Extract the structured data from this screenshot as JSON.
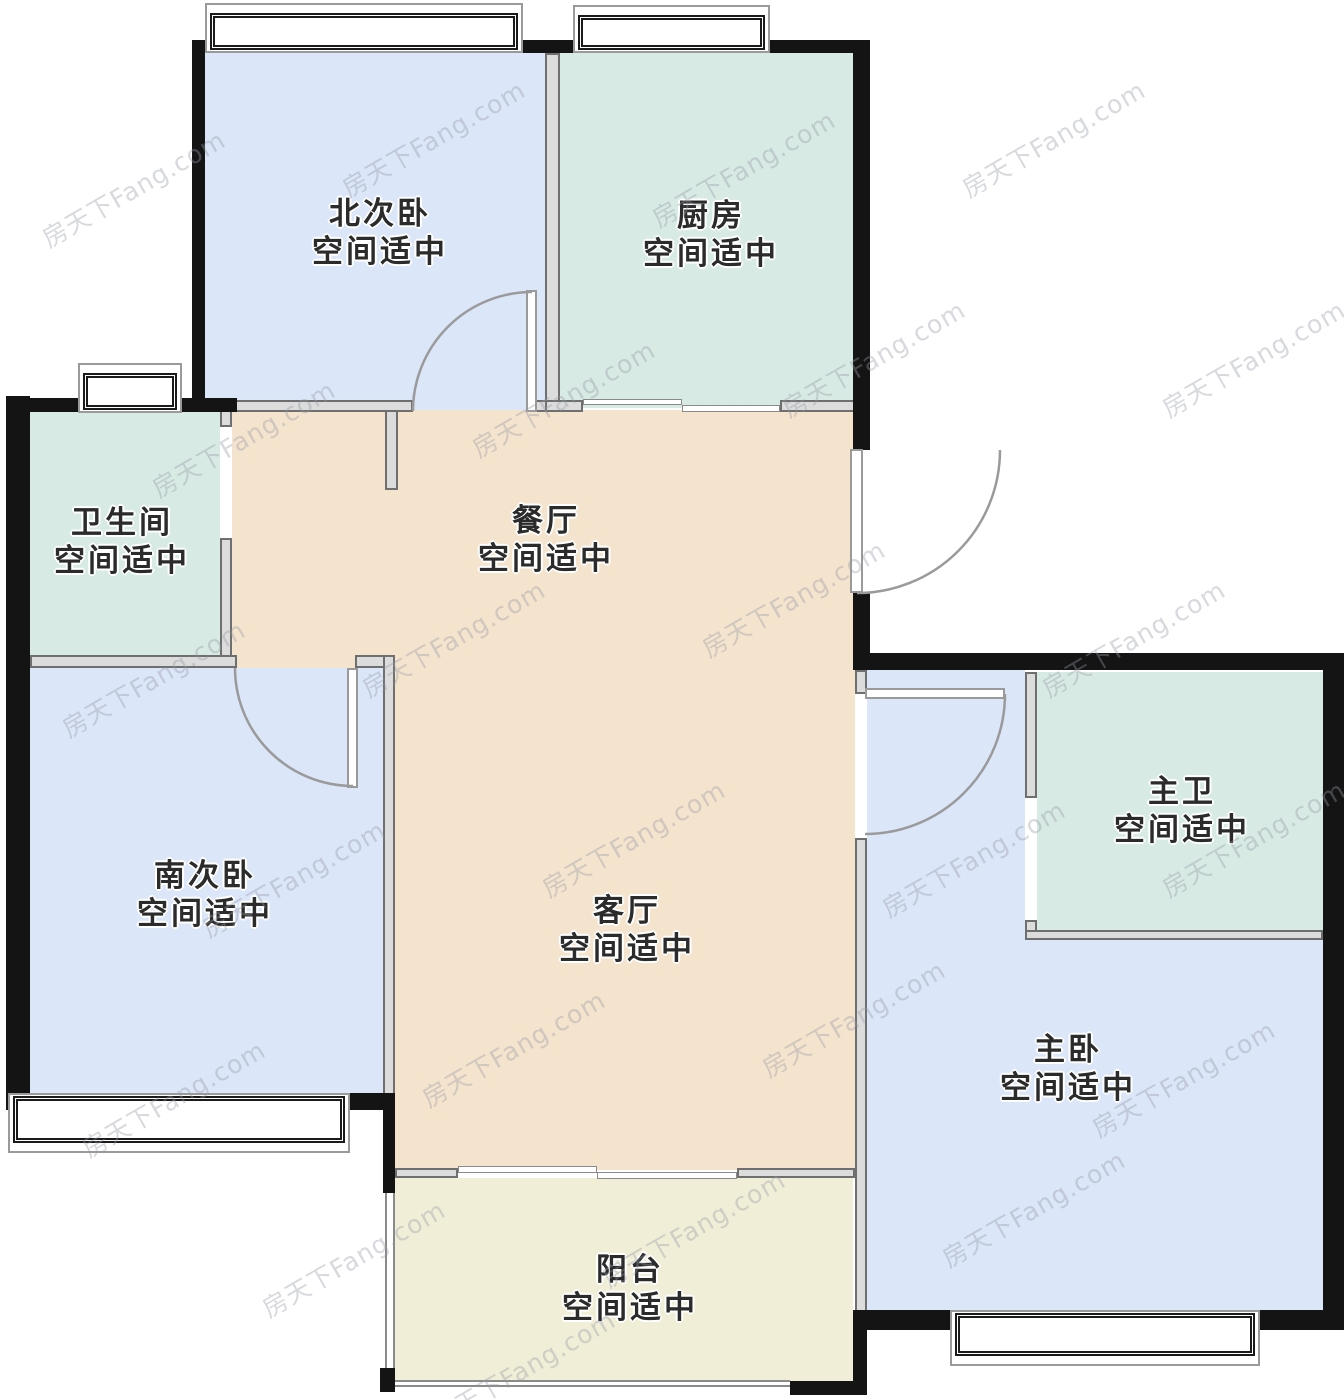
{
  "plan_title": "apartment-floor-plan",
  "watermark": {
    "text": "房天下Fang.com",
    "positions": [
      [
        30,
        170
      ],
      [
        330,
        120
      ],
      [
        640,
        150
      ],
      [
        950,
        120
      ],
      [
        1150,
        340
      ],
      [
        140,
        420
      ],
      [
        460,
        380
      ],
      [
        770,
        340
      ],
      [
        50,
        660
      ],
      [
        350,
        620
      ],
      [
        690,
        580
      ],
      [
        1030,
        620
      ],
      [
        190,
        860
      ],
      [
        530,
        820
      ],
      [
        870,
        840
      ],
      [
        1150,
        820
      ],
      [
        70,
        1080
      ],
      [
        410,
        1030
      ],
      [
        750,
        1000
      ],
      [
        1080,
        1060
      ],
      [
        250,
        1240
      ],
      [
        590,
        1210
      ],
      [
        930,
        1190
      ],
      [
        420,
        1350
      ]
    ]
  },
  "rooms": [
    {
      "id": "north-bedroom",
      "name": "北次卧",
      "status": "空间适中",
      "color": "#dbe6f9"
    },
    {
      "id": "kitchen",
      "name": "厨房",
      "status": "空间适中",
      "color": "#d7ebe4"
    },
    {
      "id": "bathroom",
      "name": "卫生间",
      "status": "空间适中",
      "color": "#d7ebe4"
    },
    {
      "id": "dining",
      "name": "餐厅",
      "status": "空间适中",
      "color": "#f4e3cd"
    },
    {
      "id": "south-bedroom",
      "name": "南次卧",
      "status": "空间适中",
      "color": "#dbe6f9"
    },
    {
      "id": "living",
      "name": "客厅",
      "status": "空间适中",
      "color": "#f4e3cd"
    },
    {
      "id": "master-bath",
      "name": "主卫",
      "status": "空间适中",
      "color": "#d7ebe4"
    },
    {
      "id": "master-bedroom",
      "name": "主卧",
      "status": "空间适中",
      "color": "#dbe6f9"
    },
    {
      "id": "balcony",
      "name": "阳台",
      "status": "空间适中",
      "color": "#f0eed7"
    }
  ],
  "colors": {
    "bedroom_fill": "#dbe6f9",
    "kitchen_bath_fill": "#d7ebe4",
    "living_dining_fill": "#f4e3cd",
    "balcony_fill": "#f0eed7",
    "exterior_wall": "#141414",
    "interior_wall": "#6f6f6f",
    "door_arc": "#9a9a9a"
  }
}
